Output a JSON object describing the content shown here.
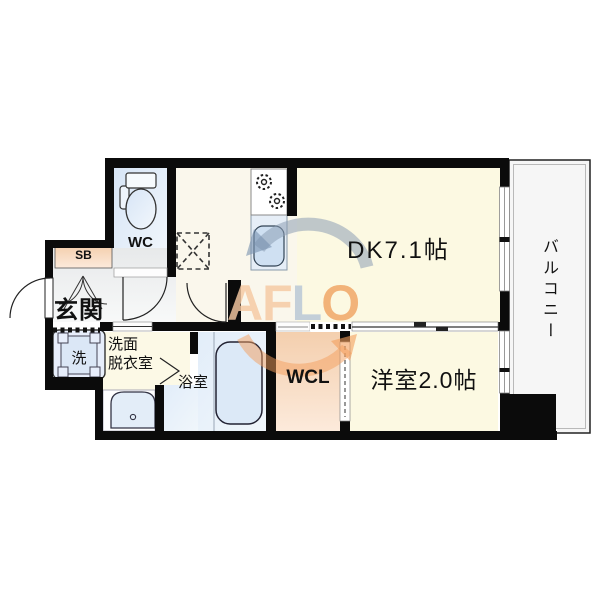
{
  "plan": {
    "rooms": {
      "wc": {
        "label": "WC"
      },
      "shoe_box": {
        "label": "SB"
      },
      "entrance": {
        "label": "玄関"
      },
      "washing_machine": {
        "label": "洗"
      },
      "washroom": {
        "label_line1": "洗面",
        "label_line2": "脱衣室"
      },
      "bathroom": {
        "label": "浴室"
      },
      "walk_in_closet": {
        "label": "WCL"
      },
      "dining_kitchen": {
        "label": "DK7.1帖"
      },
      "western_room": {
        "label": "洋室2.0帖"
      },
      "balcony": {
        "label": "バルコニー"
      }
    },
    "colors": {
      "wall": "#0B0B0B",
      "floor_cream": "#FCF9E2",
      "floor_warm_white": "#FAF7EC",
      "floor_blue": "#E5EEF8",
      "floor_peach": "#F7DCC3",
      "hall_gray": "#ECEEEF",
      "balcony_gray": "#F6F6F6"
    }
  },
  "watermark": {
    "letters": [
      "A",
      "F",
      "L",
      "O"
    ],
    "orange": "#F0A462",
    "gray_blue": "#B7C7D6"
  }
}
